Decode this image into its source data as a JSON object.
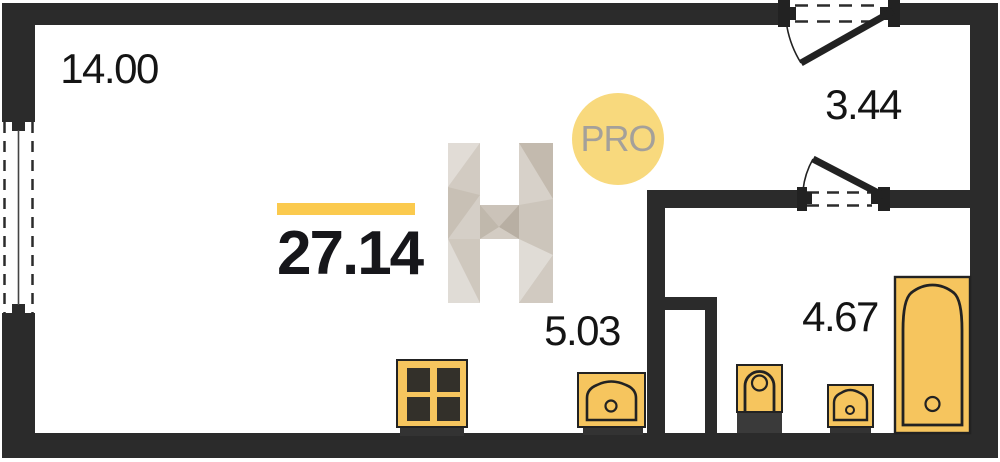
{
  "plan": {
    "type": "studio-apartment-floorplan",
    "total_area": "27.14",
    "rooms": [
      {
        "name": "living-room",
        "area": "14.00"
      },
      {
        "name": "kitchen-zone",
        "area": "5.03"
      },
      {
        "name": "hallway",
        "area": "3.44"
      },
      {
        "name": "bathroom",
        "area": "4.67"
      }
    ],
    "watermark": {
      "letter": "H",
      "badge": "PRO"
    },
    "icons": [
      "stove-icon",
      "kitchen-sink-icon",
      "toilet-icon",
      "washbasin-icon",
      "bathtub-icon",
      "window-icon",
      "entry-door-icon",
      "bathroom-door-icon",
      "watermark-h-icon",
      "pro-badge"
    ],
    "colors": {
      "wall": "#2b2b2b",
      "fixture_fill": "#f6c55e",
      "fixture_base": "#3a3a3a",
      "accent_bar": "#fbca4e",
      "badge_bg": "#f8d97d",
      "badge_text": "#a4a09a",
      "label_text": "#141414"
    }
  }
}
